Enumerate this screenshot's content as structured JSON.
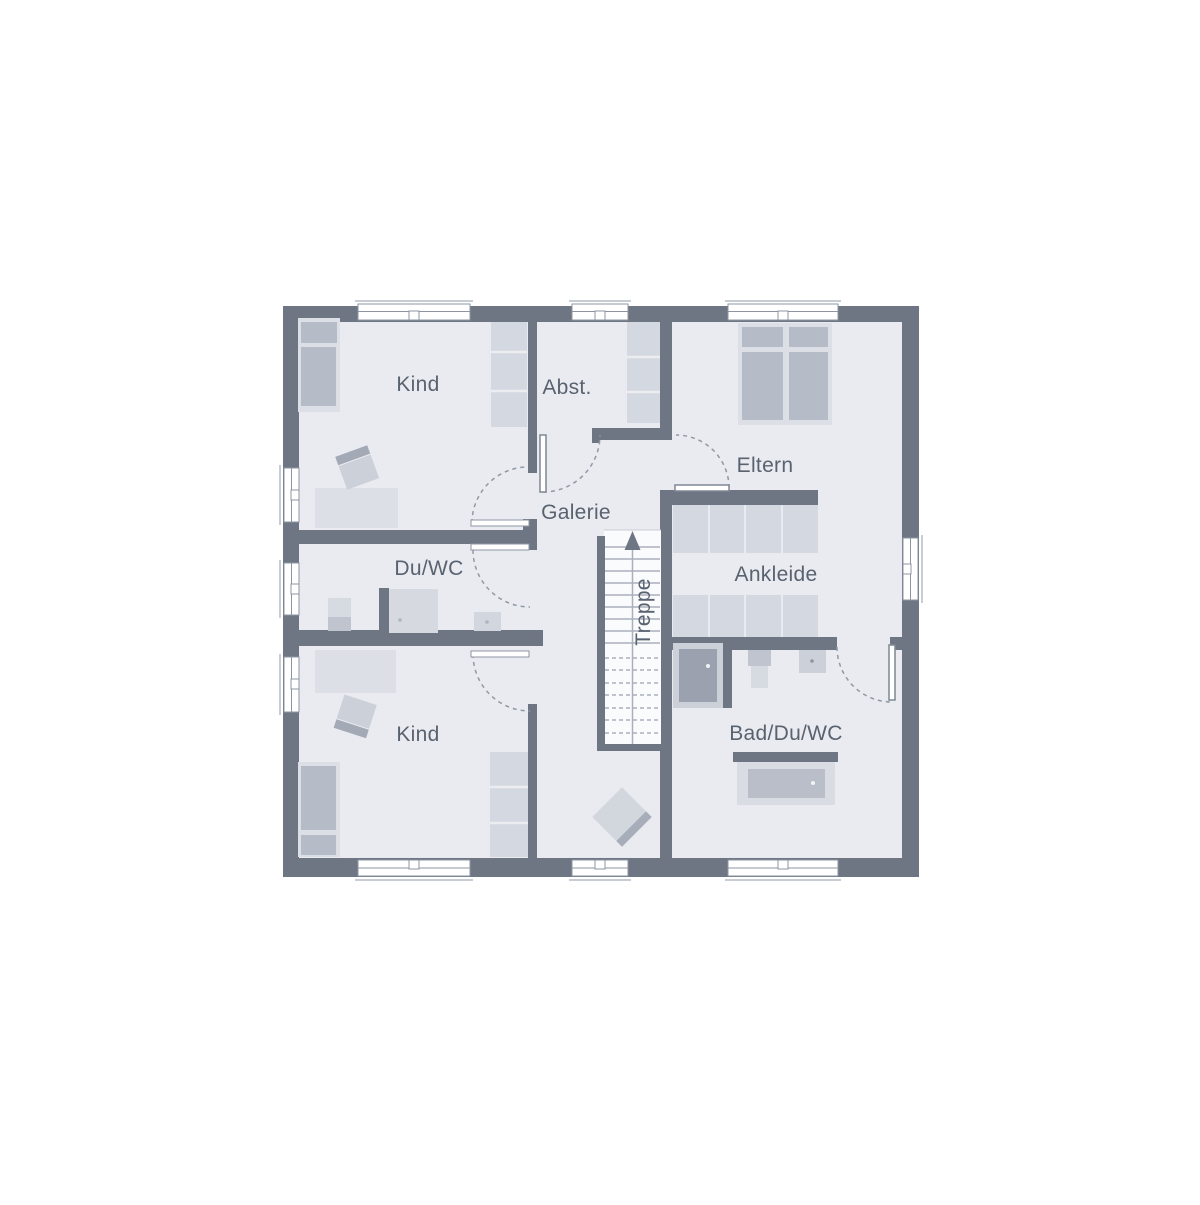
{
  "document": {
    "type": "floor-plan",
    "background": "#ffffff"
  },
  "rooms": {
    "kind_top": {
      "label": "Kind"
    },
    "abstellraum": {
      "label": "Abst."
    },
    "eltern": {
      "label": "Eltern"
    },
    "galerie": {
      "label": "Galerie"
    },
    "du_wc": {
      "label": "Du/WC"
    },
    "ankleide": {
      "label": "Ankleide"
    },
    "treppe": {
      "label": "Treppe"
    },
    "kind_bottom": {
      "label": "Kind"
    },
    "bad_du_wc": {
      "label": "Bad/Du/WC"
    }
  },
  "colors": {
    "wall": "#6e7683",
    "floor": "#e9ebf0",
    "background": "#ffffff",
    "furniture_light": "#dcdfe6",
    "furniture_medium": "#b5bbc7",
    "fixture_dark": "#9ba1ae",
    "door_line": "#9099a6",
    "label_text": "#59626f"
  }
}
